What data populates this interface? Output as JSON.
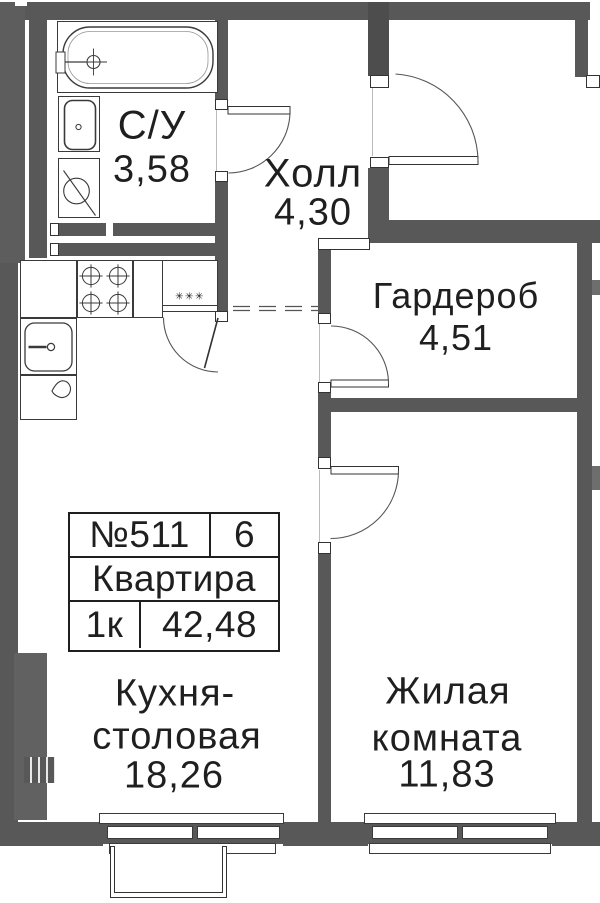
{
  "rooms": {
    "bathroom": {
      "name": "С/У",
      "area": "3,58"
    },
    "hall": {
      "name": "Холл",
      "area": "4,30"
    },
    "wardrobe": {
      "name": "Гардероб",
      "area": "4,51"
    },
    "kitchen_dining": {
      "name_line1": "Кухня-",
      "name_line2": "столовая",
      "area": "18,26"
    },
    "living_room": {
      "name_line1": "Жилая",
      "name_line2": "комната",
      "area": "11,83"
    }
  },
  "info_table": {
    "apartment_number": "№511",
    "floor": "6",
    "type_label": "Квартира",
    "rooms_label": "1к",
    "total_area": "42,48"
  },
  "symbols": {
    "fridge_mark": "✳✳✳"
  },
  "colors": {
    "wall": "#585858",
    "line": "#333333",
    "text": "#1f1f1f"
  }
}
